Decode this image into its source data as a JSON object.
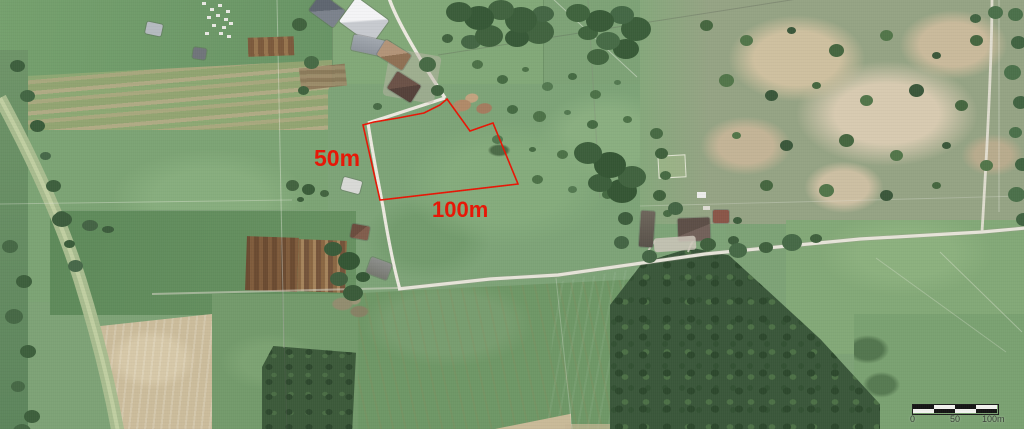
{
  "annotations": {
    "color": "#e81505",
    "side_length_label": "50m",
    "bottom_length_label": "100m",
    "plot_outline_points": "447,99 470,131 493,123 518,184 380,200 363,125 374,122 398,118 424,113 440,105"
  },
  "scalebar": {
    "start_label": "0",
    "mid_label": "50",
    "end_label": "100m"
  }
}
